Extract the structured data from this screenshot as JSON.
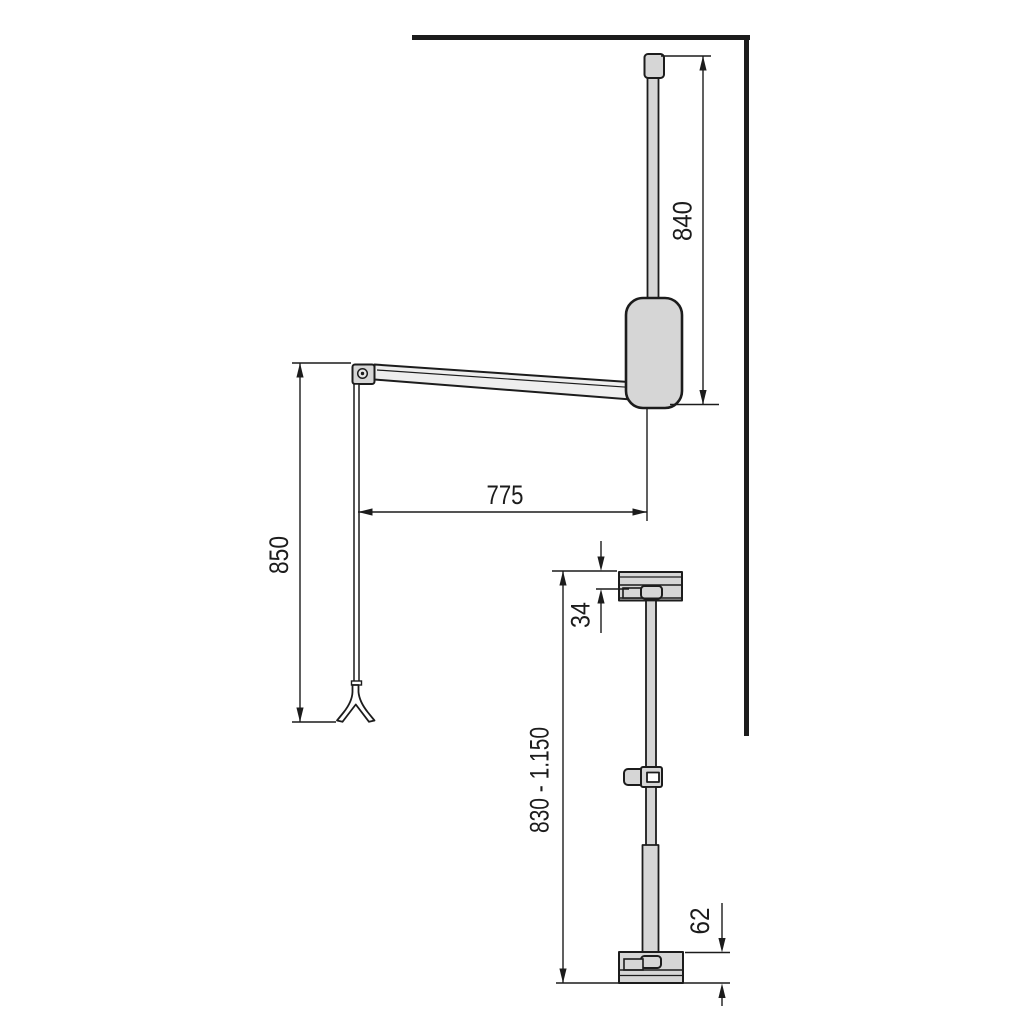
{
  "drawing": {
    "kind": "technical-dimension-drawing",
    "subject": "pull-down-wardrobe-hanger-lift",
    "views": {
      "side": {
        "dimension_ids": [
          "d840",
          "d775",
          "d850"
        ]
      },
      "front": {
        "dimension_ids": [
          "d34",
          "d830_1150",
          "d62"
        ]
      }
    }
  },
  "dims": {
    "d840": {
      "label": "840"
    },
    "d775": {
      "label": "775"
    },
    "d850": {
      "label": "850"
    },
    "d34": {
      "label": "34"
    },
    "d830_1150": {
      "label": "830 - 1.150"
    },
    "d62": {
      "label": "62"
    }
  },
  "colors": {
    "background": "#ffffff",
    "line": "#1c1c1c",
    "part_fill_gray": "#d6d6d6",
    "part_fill_light": "#eeeeee",
    "part_fill_white": "#ffffff"
  }
}
